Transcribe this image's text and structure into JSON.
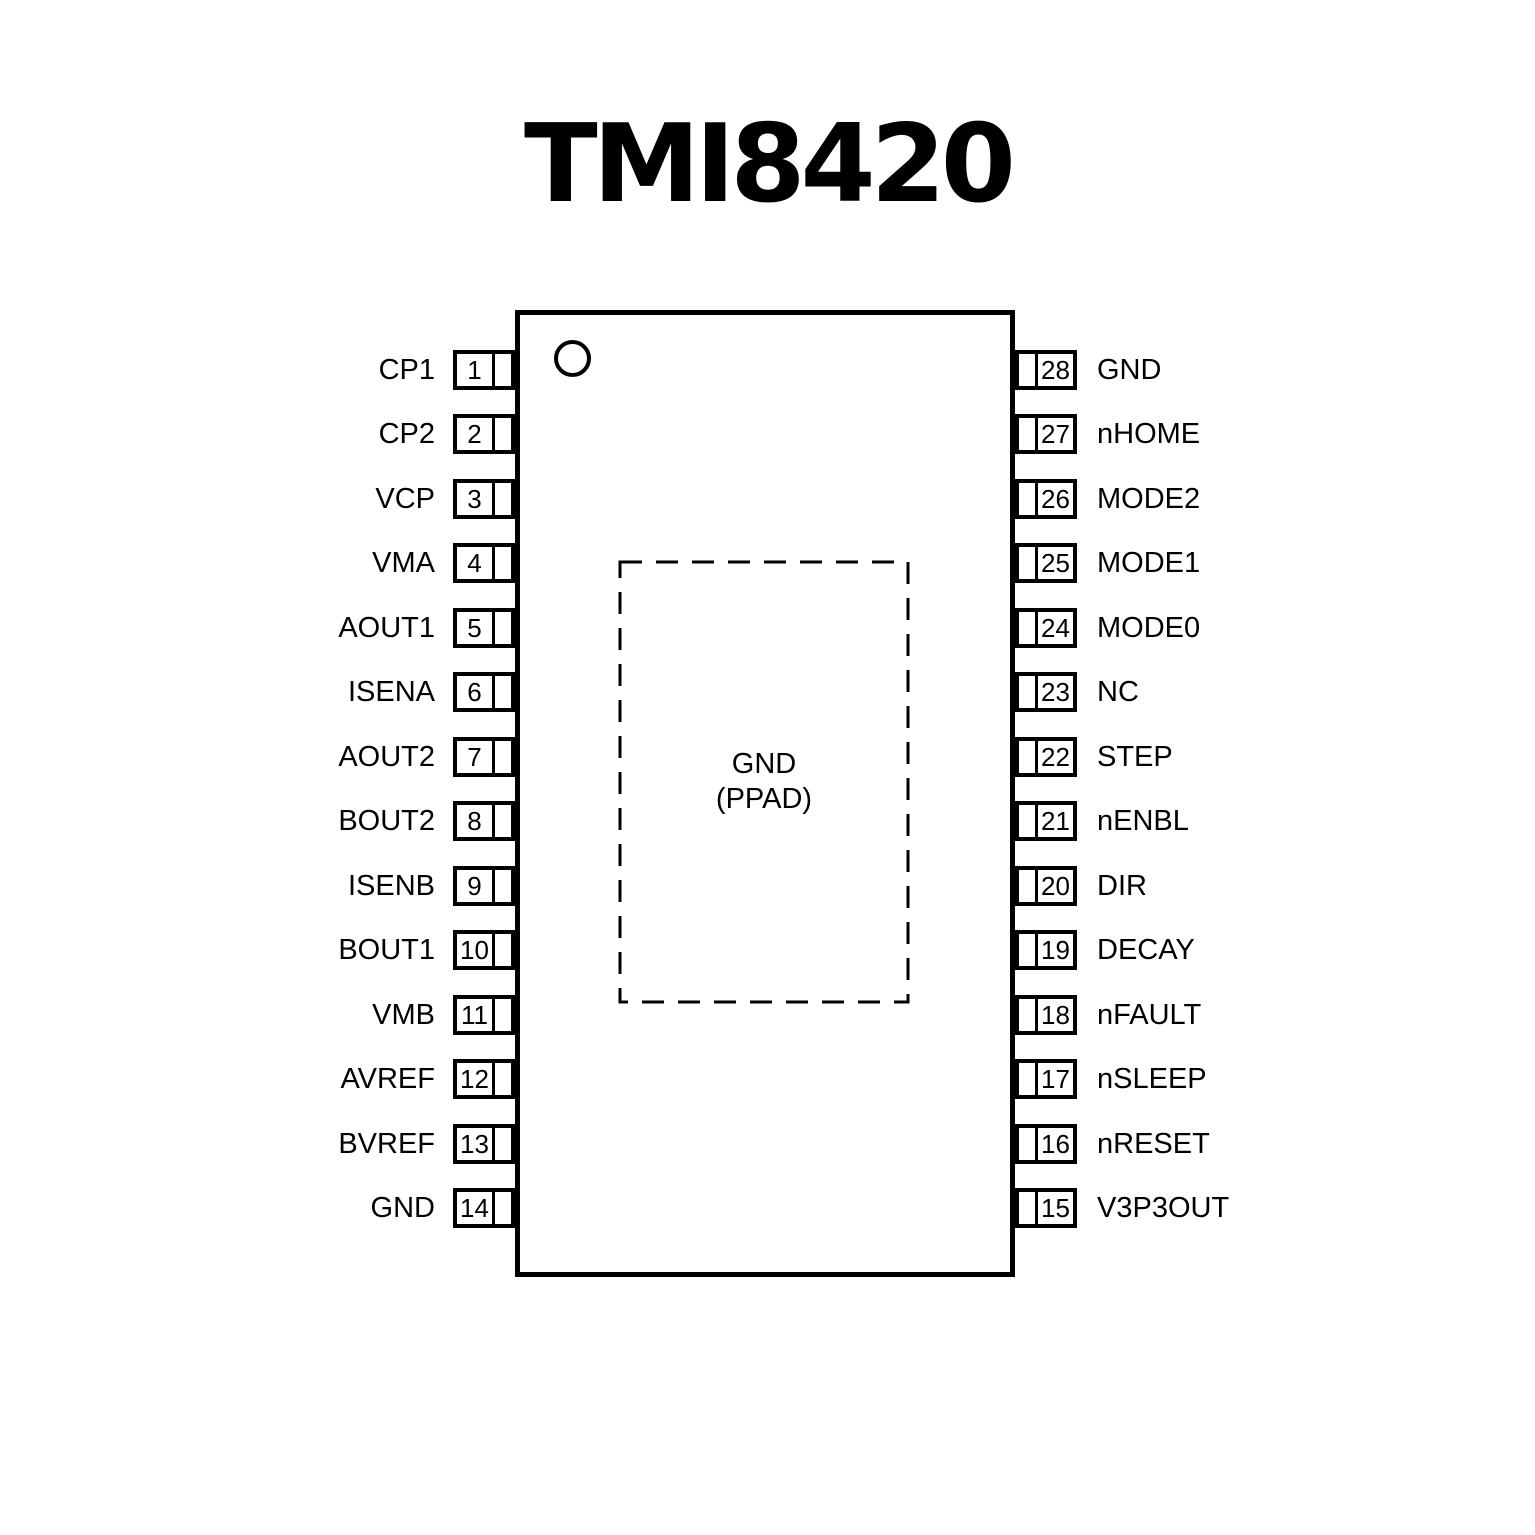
{
  "title": "TMI8420",
  "chip": {
    "thermal_pad": {
      "line1": "GND",
      "line2": "(PPAD)"
    }
  },
  "colors": {
    "line": "#000000",
    "text": "#000000",
    "background": "#ffffff"
  },
  "pins": {
    "left": [
      {
        "number": "1",
        "name": "CP1"
      },
      {
        "number": "2",
        "name": "CP2"
      },
      {
        "number": "3",
        "name": "VCP"
      },
      {
        "number": "4",
        "name": "VMA"
      },
      {
        "number": "5",
        "name": "AOUT1"
      },
      {
        "number": "6",
        "name": "ISENA"
      },
      {
        "number": "7",
        "name": "AOUT2"
      },
      {
        "number": "8",
        "name": "BOUT2"
      },
      {
        "number": "9",
        "name": "ISENB"
      },
      {
        "number": "10",
        "name": "BOUT1"
      },
      {
        "number": "11",
        "name": "VMB"
      },
      {
        "number": "12",
        "name": "AVREF"
      },
      {
        "number": "13",
        "name": "BVREF"
      },
      {
        "number": "14",
        "name": "GND"
      }
    ],
    "right": [
      {
        "number": "28",
        "name": "GND"
      },
      {
        "number": "27",
        "name": "nHOME"
      },
      {
        "number": "26",
        "name": "MODE2"
      },
      {
        "number": "25",
        "name": "MODE1"
      },
      {
        "number": "24",
        "name": "MODE0"
      },
      {
        "number": "23",
        "name": "NC"
      },
      {
        "number": "22",
        "name": "STEP"
      },
      {
        "number": "21",
        "name": "nENBL"
      },
      {
        "number": "20",
        "name": "DIR"
      },
      {
        "number": "19",
        "name": "DECAY"
      },
      {
        "number": "18",
        "name": "nFAULT"
      },
      {
        "number": "17",
        "name": "nSLEEP"
      },
      {
        "number": "16",
        "name": "nRESET"
      },
      {
        "number": "15",
        "name": "V3P3OUT"
      }
    ]
  }
}
